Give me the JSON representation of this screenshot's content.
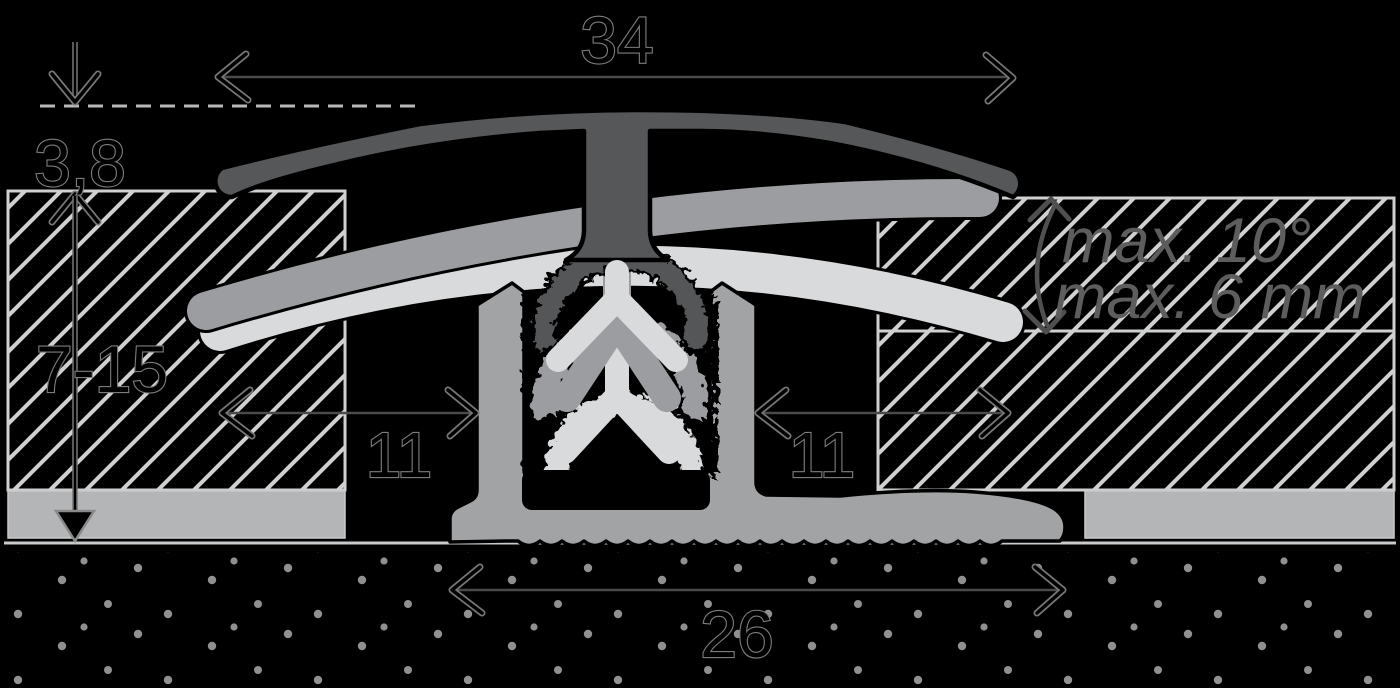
{
  "diagram": {
    "type": "flooring-transition-profile-cross-section",
    "labels": {
      "dim_top_width": "34",
      "dim_profile_thickness": "3,8",
      "dim_floor_height_range": "7-15",
      "dim_overlap_left": "11",
      "dim_overlap_right": "11",
      "dim_base_width": "26",
      "note_max_angle": "max. 10°",
      "note_max_offset": "max. 6 mm"
    },
    "colors": {
      "background": "#000000",
      "profile_dark": "#555759",
      "profile_mid": "#9b9da0",
      "profile_light": "#d9dadb",
      "base_profile": "#a1a3a5",
      "underlay": "#b3b5b7",
      "hatch_lines": "#cfd0d1",
      "subfloor_line": "#c9cacb",
      "dimension_lines": "#4a4a4a",
      "dimension_text_halo": "#7d7d7d",
      "note_text": "#5d5d5d",
      "stipple_dots": "#8f9091"
    }
  }
}
